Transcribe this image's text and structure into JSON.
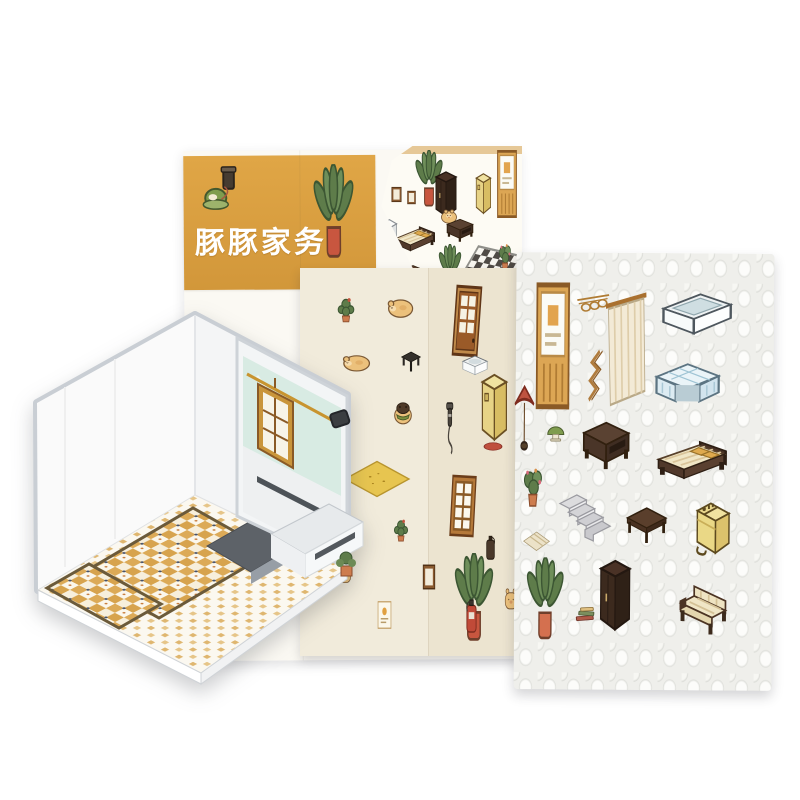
{
  "product": {
    "title": "豚豚家务"
  },
  "palette": {
    "banner_orange": "#d99f3f",
    "sheet_white": "#fbf9f3",
    "sheet_cream": "#f1ebdb",
    "sheet_textured": "#efefeb",
    "wood_tan": "#c9953b",
    "walnut_dark": "#4a3326",
    "appliance_yellow": "#e7d386",
    "plant_green": "#5e7c4a",
    "pot_red": "#c8563f",
    "pot_orange": "#d4704f",
    "glass_teal": "#d8ebe3",
    "tile_tan": "#dcaa57",
    "tub_blue": "#dcebf2"
  },
  "back_sheet": {
    "items": [
      {
        "name": "vacuum-cleaner-illustration",
        "type": "vacuum",
        "x": 198,
        "y": 164,
        "w": 48,
        "h": 52
      },
      {
        "name": "banner-plant-illustration",
        "type": "plant_red_pot",
        "x": 310,
        "y": 164,
        "w": 50,
        "h": 96
      }
    ]
  },
  "cover": {
    "items": [
      {
        "name": "cover-plant",
        "type": "plant_red_pot",
        "x": 412,
        "y": 150,
        "w": 34,
        "h": 58
      },
      {
        "name": "cover-wall-frame",
        "type": "frame_small",
        "x": 390,
        "y": 186,
        "w": 13,
        "h": 17
      },
      {
        "name": "cover-wall-frame",
        "type": "frame_small",
        "x": 406,
        "y": 190,
        "w": 11,
        "h": 15
      },
      {
        "name": "cover-bookcase",
        "type": "wardrobe",
        "x": 432,
        "y": 170,
        "w": 28,
        "h": 50
      },
      {
        "name": "cover-cabinet",
        "type": "cabinet_yellow",
        "x": 470,
        "y": 172,
        "w": 24,
        "h": 44
      },
      {
        "name": "cover-door",
        "type": "mirror_panel",
        "x": 494,
        "y": 150,
        "w": 26,
        "h": 68
      },
      {
        "name": "cover-pig",
        "type": "pig",
        "x": 438,
        "y": 206,
        "w": 22,
        "h": 20
      },
      {
        "name": "cover-fridge",
        "type": "fridge",
        "x": 376,
        "y": 218,
        "w": 24,
        "h": 42
      },
      {
        "name": "cover-bed",
        "type": "bed",
        "x": 392,
        "y": 222,
        "w": 46,
        "h": 36
      },
      {
        "name": "cover-sofa",
        "type": "nightstand",
        "x": 444,
        "y": 216,
        "w": 32,
        "h": 28
      },
      {
        "name": "cover-plant",
        "type": "plant_red_pot",
        "x": 436,
        "y": 244,
        "w": 28,
        "h": 48
      },
      {
        "name": "cover-table",
        "type": "coffee_table",
        "x": 400,
        "y": 262,
        "w": 26,
        "h": 22
      },
      {
        "name": "cover-pig",
        "type": "pig",
        "x": 404,
        "y": 282,
        "w": 18,
        "h": 16
      },
      {
        "name": "cover-checker-floor",
        "type": "checker",
        "x": 452,
        "y": 252,
        "w": 70,
        "h": 76
      },
      {
        "name": "cover-bathtub",
        "type": "bathtub",
        "x": 458,
        "y": 286,
        "w": 48,
        "h": 30
      },
      {
        "name": "cover-pig-bathing",
        "type": "pig_pink",
        "x": 472,
        "y": 268,
        "w": 20,
        "h": 20
      },
      {
        "name": "cover-plant",
        "type": "plant_flower",
        "x": 494,
        "y": 238,
        "w": 22,
        "h": 38
      },
      {
        "name": "cover-stairs",
        "type": "stairs",
        "x": 500,
        "y": 272,
        "w": 22,
        "h": 34
      }
    ]
  },
  "middle_sheet": {
    "items": [
      {
        "name": "cactus-sticker",
        "type": "cactus",
        "x": 333,
        "y": 293,
        "w": 26,
        "h": 32
      },
      {
        "name": "lying-pig-sticker",
        "type": "pig_lying",
        "x": 385,
        "y": 291,
        "w": 30,
        "h": 32
      },
      {
        "name": "sleeping-pig-sticker",
        "type": "pig_lying",
        "x": 340,
        "y": 348,
        "w": 32,
        "h": 28
      },
      {
        "name": "black-stool-sticker",
        "type": "stool",
        "x": 398,
        "y": 349,
        "w": 26,
        "h": 25
      },
      {
        "name": "pig-with-jacket-sticker",
        "type": "pig_jacket",
        "x": 390,
        "y": 398,
        "w": 26,
        "h": 30
      },
      {
        "name": "yellow-rug-sticker",
        "type": "rug_yellow",
        "x": 343,
        "y": 460,
        "w": 68,
        "h": 38
      },
      {
        "name": "cactus-sticker",
        "type": "cactus",
        "x": 336,
        "y": 520,
        "w": 20,
        "h": 27
      },
      {
        "name": "cactus-sticker",
        "type": "cactus",
        "x": 390,
        "y": 515,
        "w": 22,
        "h": 29
      },
      {
        "name": "small-pig-sticker",
        "type": "pig_peek",
        "x": 336,
        "y": 565,
        "w": 17,
        "h": 20
      },
      {
        "name": "poster-frame-sticker",
        "type": "frame_poster",
        "x": 376,
        "y": 600,
        "w": 17,
        "h": 30
      },
      {
        "name": "wooden-door-sticker",
        "type": "door",
        "x": 448,
        "y": 284,
        "w": 38,
        "h": 74,
        "r": 4
      },
      {
        "name": "basin-sticker",
        "type": "basin",
        "x": 456,
        "y": 350,
        "w": 38,
        "h": 30
      },
      {
        "name": "yellow-cabinet-sticker",
        "type": "cabinet_yellow",
        "x": 472,
        "y": 372,
        "w": 40,
        "h": 72
      },
      {
        "name": "shower-head-sticker",
        "type": "shower",
        "x": 438,
        "y": 402,
        "w": 24,
        "h": 55
      },
      {
        "name": "red-mat-sticker",
        "type": "mat_red",
        "x": 483,
        "y": 441,
        "w": 20,
        "h": 11
      },
      {
        "name": "window-frame-sticker",
        "type": "window",
        "x": 447,
        "y": 474,
        "w": 32,
        "h": 64,
        "r": 3
      },
      {
        "name": "dark-extinguisher-sticker",
        "type": "ext_dark",
        "x": 481,
        "y": 534,
        "w": 19,
        "h": 28
      },
      {
        "name": "banana-plant-sticker",
        "type": "plant_red_pot",
        "x": 450,
        "y": 553,
        "w": 48,
        "h": 90
      },
      {
        "name": "brown-frame-sticker",
        "type": "frame_small",
        "x": 421,
        "y": 563,
        "w": 16,
        "h": 28
      },
      {
        "name": "fire-extinguisher-sticker",
        "type": "ext_red",
        "x": 460,
        "y": 597,
        "w": 23,
        "h": 38
      },
      {
        "name": "pig-sticker",
        "type": "pig_peek",
        "x": 503,
        "y": 586,
        "w": 16,
        "h": 26
      }
    ]
  },
  "right_sheet": {
    "items": [
      {
        "name": "framed-panel-sticker",
        "type": "mirror_panel",
        "x": 530,
        "y": 283,
        "w": 44,
        "h": 127
      },
      {
        "name": "coat-rack-sticker",
        "type": "coat_rack",
        "x": 574,
        "y": 291,
        "w": 36,
        "h": 30
      },
      {
        "name": "towel-ladder-sticker",
        "type": "towel_ladder",
        "x": 581,
        "y": 348,
        "w": 28,
        "h": 57
      },
      {
        "name": "curtain-sticker",
        "type": "curtain",
        "x": 604,
        "y": 290,
        "w": 42,
        "h": 120
      },
      {
        "name": "bathtub-sticker",
        "type": "bathtub",
        "x": 656,
        "y": 285,
        "w": 80,
        "h": 56
      },
      {
        "name": "tiled-counter-sticker",
        "type": "tile_counter",
        "x": 650,
        "y": 357,
        "w": 74,
        "h": 58
      },
      {
        "name": "floor-lamp-sticker",
        "type": "lamp_parasol",
        "x": 510,
        "y": 383,
        "w": 28,
        "h": 74
      },
      {
        "name": "small-lamp-sticker",
        "type": "lamp_green",
        "x": 543,
        "y": 422,
        "w": 25,
        "h": 25
      },
      {
        "name": "nightstand-sticker",
        "type": "nightstand",
        "x": 578,
        "y": 416,
        "w": 56,
        "h": 58
      },
      {
        "name": "bed-sticker",
        "type": "bed",
        "x": 652,
        "y": 434,
        "w": 80,
        "h": 55
      },
      {
        "name": "flower-plant-sticker",
        "type": "plant_flower",
        "x": 516,
        "y": 461,
        "w": 34,
        "h": 52
      },
      {
        "name": "striped-rug-sticker",
        "type": "rug_stripe",
        "x": 523,
        "y": 531,
        "w": 28,
        "h": 22
      },
      {
        "name": "stairs-sticker",
        "type": "stairs",
        "x": 553,
        "y": 483,
        "w": 60,
        "h": 62
      },
      {
        "name": "coffee-table-sticker",
        "type": "coffee_table",
        "x": 624,
        "y": 500,
        "w": 46,
        "h": 50
      },
      {
        "name": "washing-machine-sticker",
        "type": "washer",
        "x": 690,
        "y": 498,
        "w": 48,
        "h": 62
      },
      {
        "name": "banana-plant-sticker",
        "type": "plant_orange_pot",
        "x": 523,
        "y": 558,
        "w": 46,
        "h": 84
      },
      {
        "name": "wardrobe-sticker",
        "type": "wardrobe",
        "x": 596,
        "y": 558,
        "w": 40,
        "h": 78
      },
      {
        "name": "books-sticker",
        "type": "books",
        "x": 572,
        "y": 603,
        "w": 30,
        "h": 25
      },
      {
        "name": "sofa-sticker",
        "type": "sofa",
        "x": 676,
        "y": 580,
        "w": 56,
        "h": 60
      }
    ]
  },
  "room_model": {
    "features": [
      "white-walls",
      "tatami-tile-floor",
      "glass-shower-panel",
      "wooden-window-frame",
      "counter-ledge",
      "sunken-pit",
      "small-cactus",
      "wall-speaker"
    ]
  }
}
